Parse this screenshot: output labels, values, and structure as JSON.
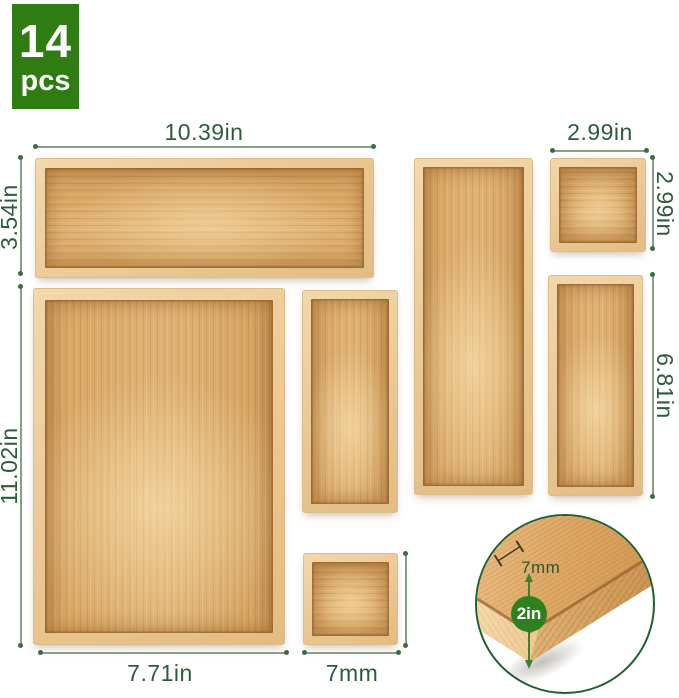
{
  "badge": {
    "count": "14",
    "unit": "pcs"
  },
  "dimension_labels": {
    "top_tray_width": "10.39in",
    "top_tray_height": "3.54in",
    "small_square_width": "2.99in",
    "small_square_height": "2.99in",
    "medium_tall_height": "6.81in",
    "large_tray_height": "11.02in",
    "large_tray_width": "7.71in",
    "bottom_square_width": "7mm"
  },
  "inset": {
    "wall_thickness": "7mm",
    "depth": "2in"
  },
  "colors": {
    "badge_green": "#2f7d12",
    "label_green": "#2e5b39",
    "dimension_line_green": "#84a186",
    "circle_outline_green": "#1f6030",
    "depth_badge_green": "#2e8020",
    "bamboo_rim_light": "#f0d2a2",
    "bamboo_interior": "#ddab6b"
  }
}
